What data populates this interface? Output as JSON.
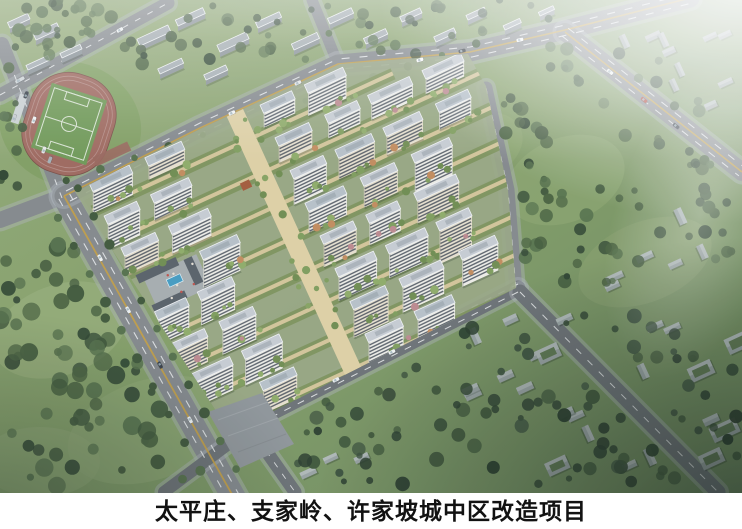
{
  "caption": {
    "text": "太平庄、支家岭、许家坡城中区改造项目"
  },
  "scene": {
    "landmarks": [
      "running-track",
      "soccer-field",
      "residential-compound",
      "central-walkway",
      "swimming-pool-plaza",
      "park-forest",
      "village-houses",
      "road-network",
      "haze"
    ]
  },
  "palette": {
    "road": "#85898d",
    "road_dark": "#6d7276",
    "lane_white": "#e9ebec",
    "lane_yellow": "#c9a13e",
    "lawn": "#86a069",
    "lawn_light": "#95ae77",
    "forest_dark": "#2e4530",
    "forest": "#3f5839",
    "forest_light": "#55714a",
    "building_white": "#f0efe8",
    "building_cream": "#e9e2cf",
    "window_band": "#3a4350",
    "roof": "#c9ced4",
    "roof_dark": "#929ba4",
    "block_gray": "#a6aeb3",
    "block_side": "#8a9297",
    "track_red": "#a2685d",
    "pitch_green": "#6f9b54",
    "pool_blue": "#419ec6",
    "walkway_tan": "#dbc99b",
    "olive_strip": "#7d935a",
    "house_gray": "#9aa4a4",
    "caption_bg": "#ffffff",
    "caption_text": "#121212"
  }
}
